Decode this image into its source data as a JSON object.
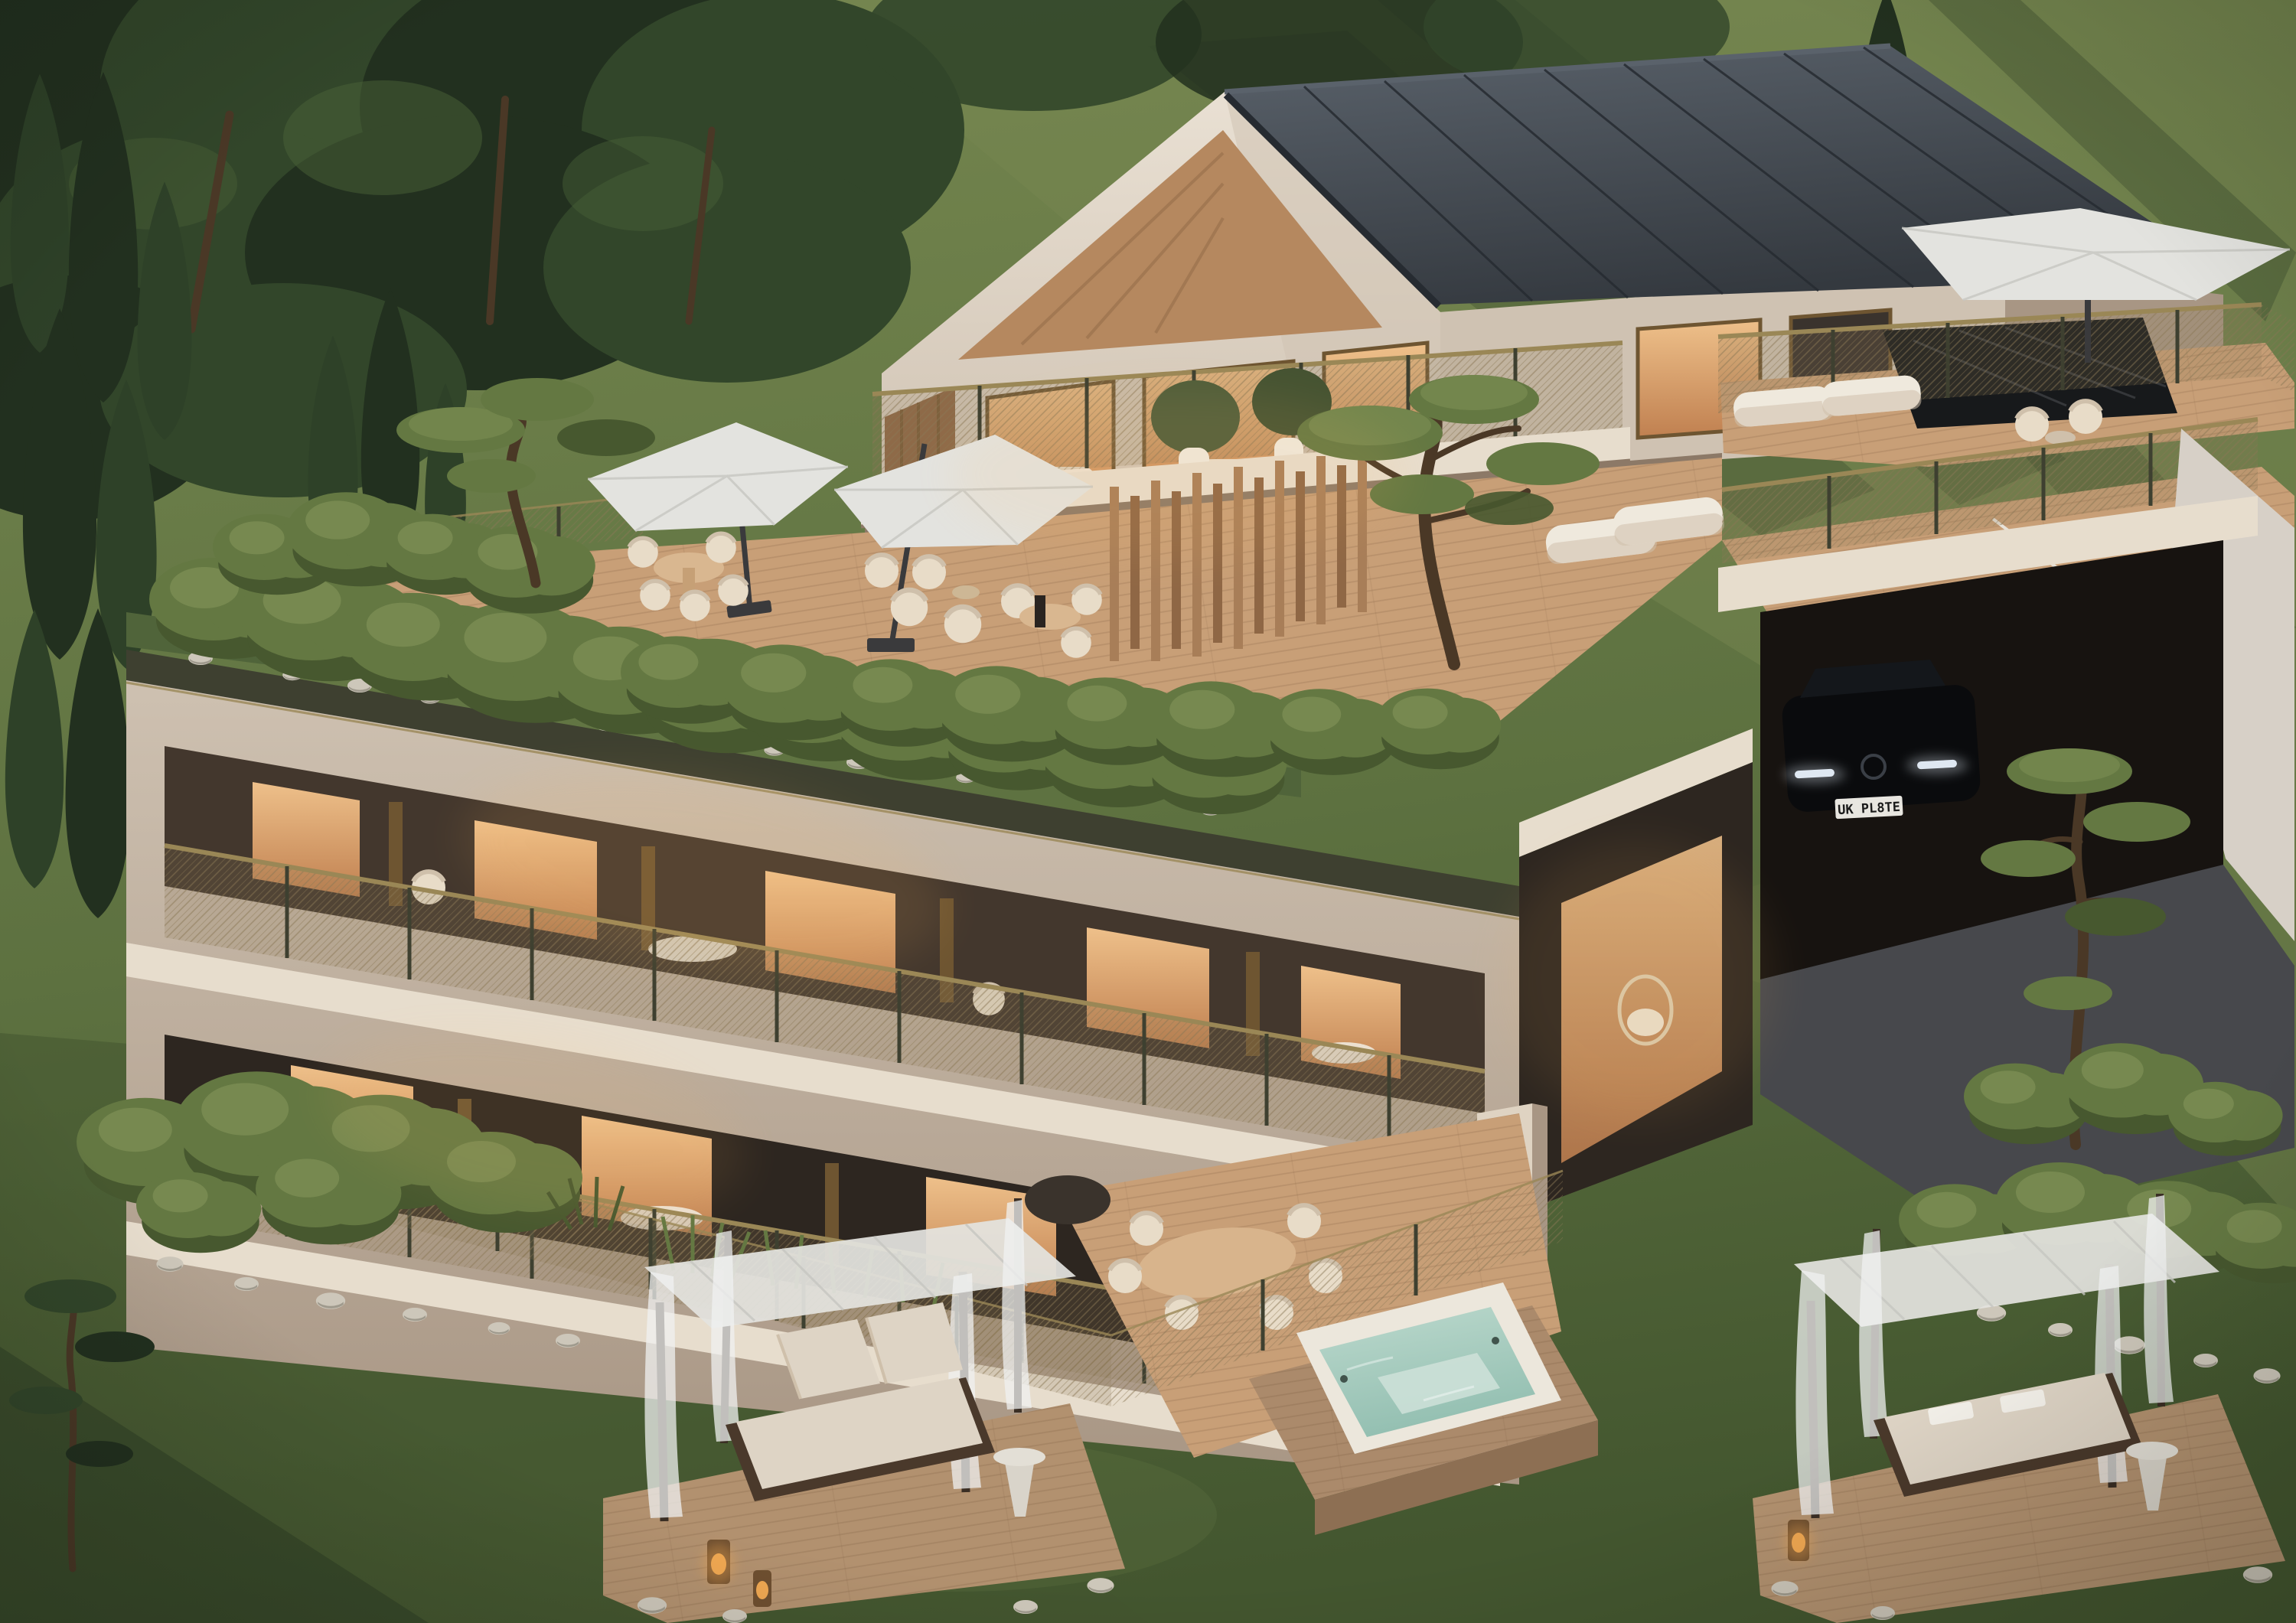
{
  "scene": {
    "type": "architectural-exterior-render",
    "time_of_day": "dusk",
    "subject": "hillside villa with terraces, green roof, garden cabanas and hot tub",
    "car": {
      "plate": "UK PL8TE"
    },
    "elements": [
      "gable-house",
      "metal-roof",
      "roof-terrace",
      "middle-terrace",
      "umbrellas",
      "slat-screen",
      "bonsai-pines",
      "green-roof-shrubs",
      "balcony-block",
      "garage",
      "black-car",
      "stairs",
      "driveway",
      "lawn",
      "cabana-left",
      "cabana-right",
      "hot-tub",
      "rock-borders",
      "cypress-trees",
      "tree-canopy"
    ]
  },
  "palette": {
    "grassBase": "#5d7140",
    "grassLight": "#75864f",
    "grassDark": "#43562f",
    "grassShade": "#2c3b24",
    "treeDark": "#22301f",
    "treeMid": "#32462a",
    "treeLight": "#4a6137",
    "cypress": "#2e4128",
    "trunk": "#4a3826",
    "bushLight": "#7d8f55",
    "bushMid": "#647842",
    "bushDark": "#47582f",
    "roofGrass": "#50643a",
    "wallLight": "#e9e0d3",
    "wallMid": "#cfc2b2",
    "wallDark": "#a89684",
    "wallShade": "#8c7967",
    "trimDark": "#3e4030",
    "brass": "#9a8756",
    "meshTone": "#8a7754",
    "roofDark": "#34393f",
    "roofLight": "#5a626b",
    "seam": "#262b31",
    "woodSoffit": "#b5885f",
    "woodSlat": "#a87e58",
    "woodSlatDark": "#8f6745",
    "deck": "#c89f77",
    "deckDark": "#a87f5c",
    "deckPlank": "#5a3c23",
    "glassWarm": "#eec08a",
    "glassDeep": "#c08050",
    "glassDark": "#3a332d",
    "frame": "#6e5531",
    "canopy": "#e3e3df",
    "canopyShade": "#c6c6c1",
    "poleDark": "#3a3a3c",
    "cushion": "#e8dcc8",
    "cushionShade": "#cfc0ab",
    "white": "#efe9dd",
    "recessDark": "#43372d",
    "interiorDark": "#2d2620",
    "slab": "#e7ddcd",
    "pillar": "#dfd3c2",
    "marble": "#17191b",
    "marbleVein": "#8e9496",
    "stair": "#d8d2c7",
    "retWall": "#d7d0c7",
    "asphalt": "#47484c",
    "garage": "#171310",
    "carBody": "#0a0b0d",
    "carLight": "#dfe8f2",
    "plateBg": "#e8e6e0",
    "plateText": "#1b1b1b",
    "rock": "#cdc7ba",
    "rockShade": "#948e82",
    "tubShell": "#ece7dc",
    "waterLight": "#bcd9cd",
    "waterDeep": "#93bfb1",
    "waterSeat": "#cfe2d9",
    "platform": "#ab8a6b",
    "platformDark": "#8d6f53",
    "cabanaDeck": "#b2916f",
    "postDark": "#3a2e24",
    "curtain": "#f0f2f1",
    "mattress": "#ded4c5",
    "bedBase": "#4a392b",
    "lanternBody": "#6e4f30",
    "lanternGlow": "#f0a852",
    "towel": "#f4f1ea",
    "glow": "#ffb95e",
    "shadow": "#1e2617"
  }
}
